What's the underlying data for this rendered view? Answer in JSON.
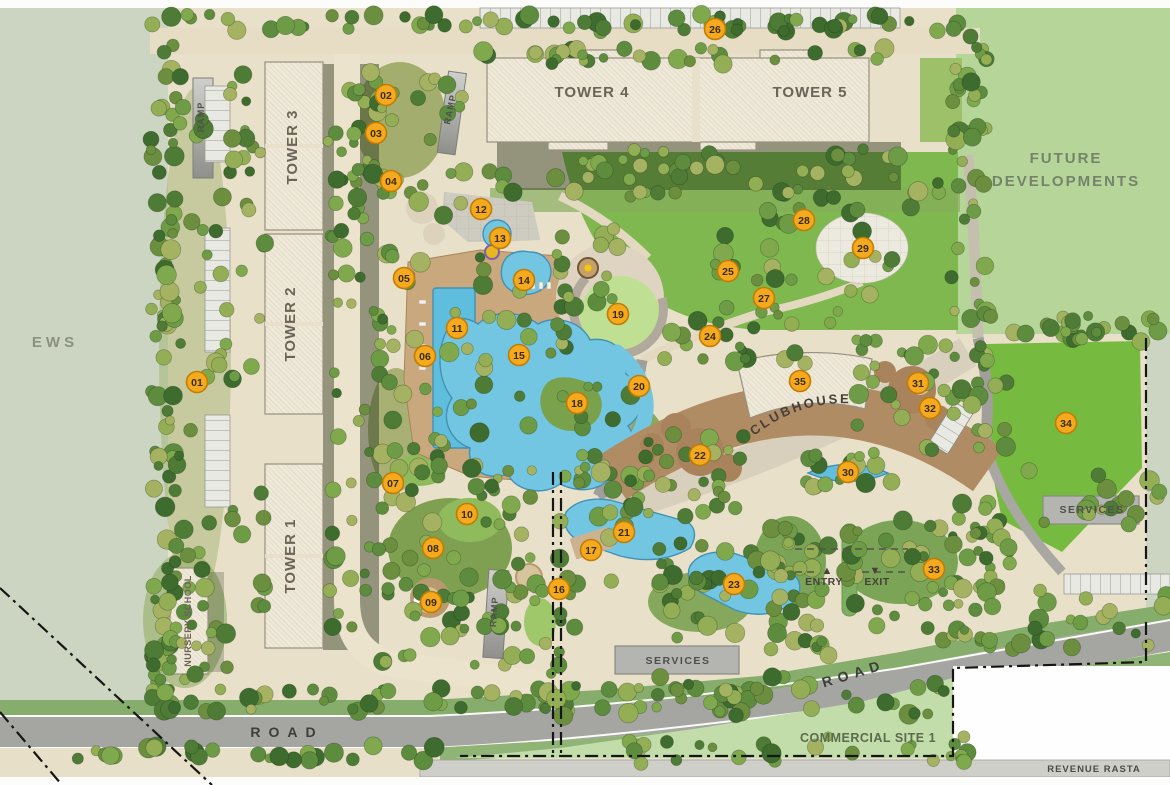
{
  "plan": {
    "title": "Residential Master Plan",
    "areas": {
      "ews": "EWS",
      "future_line1": "FUTURE",
      "future_line2": "DEVELOPMENTS",
      "commercial_site": "COMMERCIAL SITE 1",
      "revenue_rasta": "REVENUE RASTA"
    },
    "buildings": {
      "tower1": "TOWER 1",
      "tower2": "TOWER 2",
      "tower3": "TOWER 3",
      "tower4": "TOWER 4",
      "tower5": "TOWER 5",
      "clubhouse": "CLUBHOUSE",
      "nursery": "NURSERY SCHOOL",
      "services": "SERVICES",
      "ramp": "RAMP"
    },
    "gate": {
      "entry": "ENTRY",
      "exit": "EXIT",
      "entry_arrow": "▲",
      "exit_arrow": "▼"
    },
    "roads": {
      "south": "ROAD",
      "east": "ROAD"
    },
    "labels": [
      {
        "id": "ews",
        "text": "EWS",
        "x": 55,
        "y": 347,
        "size": 15,
        "ls": 4,
        "rot": 0,
        "color": "#8a9180"
      },
      {
        "id": "future-developments-1",
        "text": "FUTURE",
        "x": 1066,
        "y": 163,
        "size": 15,
        "ls": 2,
        "rot": 0,
        "color": "#75836b"
      },
      {
        "id": "future-developments-2",
        "text": "DEVELOPMENTS",
        "x": 1066,
        "y": 186,
        "size": 15,
        "ls": 2,
        "rot": 0,
        "color": "#75836b"
      },
      {
        "id": "tower-3",
        "text": "TOWER 3",
        "x": 297,
        "y": 147,
        "size": 15,
        "ls": 1,
        "rot": -90,
        "color": "#6b6457"
      },
      {
        "id": "tower-2",
        "text": "TOWER 2",
        "x": 295,
        "y": 324,
        "size": 15,
        "ls": 1,
        "rot": -90,
        "color": "#6b6457"
      },
      {
        "id": "tower-1",
        "text": "TOWER 1",
        "x": 295,
        "y": 556,
        "size": 15,
        "ls": 1,
        "rot": -90,
        "color": "#6b6457"
      },
      {
        "id": "tower-4",
        "text": "TOWER 4",
        "x": 592,
        "y": 97,
        "size": 15,
        "ls": 1,
        "rot": 0,
        "color": "#6b6457"
      },
      {
        "id": "tower-5",
        "text": "TOWER 5",
        "x": 810,
        "y": 97,
        "size": 15,
        "ls": 1,
        "rot": 0,
        "color": "#6b6457"
      },
      {
        "id": "nursery-school",
        "text": "NURSERY SCHOOL",
        "x": 191,
        "y": 621,
        "size": 9,
        "ls": 0.5,
        "rot": -90,
        "color": "#6b6457"
      },
      {
        "id": "ramp-west",
        "text": "RAMP",
        "x": 204,
        "y": 117,
        "size": 9,
        "ls": 1,
        "rot": -90,
        "color": "#4f4f4c"
      },
      {
        "id": "ramp-mid",
        "text": "RAMP",
        "x": 453,
        "y": 110,
        "size": 9,
        "ls": 1,
        "rot": -78,
        "color": "#4f4f4c"
      },
      {
        "id": "ramp-south",
        "text": "RAMP",
        "x": 497,
        "y": 612,
        "size": 9,
        "ls": 1,
        "rot": -86,
        "color": "#4f4f4c"
      },
      {
        "id": "clubhouse",
        "text": "CLUBHOUSE",
        "curve": true,
        "size": 13,
        "ls": 2.5,
        "color": "#45403a"
      },
      {
        "id": "services-south",
        "text": "SERVICES",
        "x": 678,
        "y": 664,
        "size": 10.5,
        "ls": 1.5,
        "rot": 0,
        "color": "#4f4f4c"
      },
      {
        "id": "services-east",
        "text": "SERVICES",
        "x": 1092,
        "y": 513,
        "size": 10.5,
        "ls": 1.5,
        "rot": 0,
        "color": "#4f4f4c"
      },
      {
        "id": "entry",
        "text": "ENTRY",
        "x": 824,
        "y": 585,
        "size": 10.5,
        "ls": 0.5,
        "rot": 0,
        "color": "#46413a"
      },
      {
        "id": "exit",
        "text": "EXIT",
        "x": 877,
        "y": 585,
        "size": 10.5,
        "ls": 0.5,
        "rot": 0,
        "color": "#46413a"
      },
      {
        "id": "entry-arrow",
        "text": "▲",
        "x": 827,
        "y": 574,
        "size": 11,
        "ls": 0,
        "rot": 0,
        "color": "#46413a"
      },
      {
        "id": "exit-arrow",
        "text": "▼",
        "x": 875,
        "y": 574,
        "size": 11,
        "ls": 0,
        "rot": 0,
        "color": "#46413a"
      },
      {
        "id": "road-south",
        "text": "ROAD",
        "x": 287,
        "y": 737,
        "size": 14,
        "ls": 8,
        "rot": 0,
        "color": "#3d3d3b"
      },
      {
        "id": "road-east",
        "text": "ROAD",
        "x": 855,
        "y": 678,
        "size": 14,
        "ls": 6,
        "rot": -17,
        "color": "#3d3d3b"
      },
      {
        "id": "commercial-site-1",
        "text": "COMMERCIAL SITE 1",
        "x": 868,
        "y": 742,
        "size": 12.5,
        "ls": 0.5,
        "rot": 0,
        "color": "#5a6b4e"
      },
      {
        "id": "revenue-rasta",
        "text": "REVENUE RASTA",
        "x": 1094,
        "y": 772,
        "size": 9.5,
        "ls": 1,
        "rot": 0,
        "color": "#4a4a48"
      }
    ],
    "markers": [
      {
        "n": "01",
        "x": 197,
        "y": 382
      },
      {
        "n": "02",
        "x": 386,
        "y": 95
      },
      {
        "n": "03",
        "x": 376,
        "y": 133
      },
      {
        "n": "04",
        "x": 391,
        "y": 181
      },
      {
        "n": "05",
        "x": 404,
        "y": 278
      },
      {
        "n": "06",
        "x": 425,
        "y": 356
      },
      {
        "n": "07",
        "x": 393,
        "y": 483
      },
      {
        "n": "08",
        "x": 433,
        "y": 548
      },
      {
        "n": "09",
        "x": 431,
        "y": 602
      },
      {
        "n": "10",
        "x": 467,
        "y": 514
      },
      {
        "n": "11",
        "x": 457,
        "y": 328
      },
      {
        "n": "12",
        "x": 481,
        "y": 209
      },
      {
        "n": "13",
        "x": 500,
        "y": 238
      },
      {
        "n": "14",
        "x": 524,
        "y": 280
      },
      {
        "n": "15",
        "x": 519,
        "y": 355
      },
      {
        "n": "16",
        "x": 559,
        "y": 589
      },
      {
        "n": "17",
        "x": 591,
        "y": 550
      },
      {
        "n": "18",
        "x": 577,
        "y": 403
      },
      {
        "n": "19",
        "x": 618,
        "y": 314
      },
      {
        "n": "20",
        "x": 639,
        "y": 386
      },
      {
        "n": "21",
        "x": 624,
        "y": 532
      },
      {
        "n": "22",
        "x": 700,
        "y": 455
      },
      {
        "n": "23",
        "x": 734,
        "y": 584
      },
      {
        "n": "24",
        "x": 710,
        "y": 336
      },
      {
        "n": "25",
        "x": 728,
        "y": 271
      },
      {
        "n": "26",
        "x": 715,
        "y": 29
      },
      {
        "n": "27",
        "x": 764,
        "y": 298
      },
      {
        "n": "28",
        "x": 804,
        "y": 220
      },
      {
        "n": "29",
        "x": 863,
        "y": 248
      },
      {
        "n": "30",
        "x": 848,
        "y": 472
      },
      {
        "n": "31",
        "x": 918,
        "y": 383
      },
      {
        "n": "32",
        "x": 930,
        "y": 408
      },
      {
        "n": "33",
        "x": 934,
        "y": 569
      },
      {
        "n": "34",
        "x": 1066,
        "y": 423
      },
      {
        "n": "35",
        "x": 800,
        "y": 381
      }
    ],
    "colors": {
      "marker_fill": "#f5a91f",
      "marker_stroke": "#c17c02",
      "marker_text": "#3a2c00",
      "water": "#72c6e2",
      "lawn": "#7fb84e",
      "site_base": "#e9e0c9",
      "ews_green": "#ccd5c1",
      "future_green": "#b6d699",
      "road_gray": "#a5a5a2"
    }
  }
}
